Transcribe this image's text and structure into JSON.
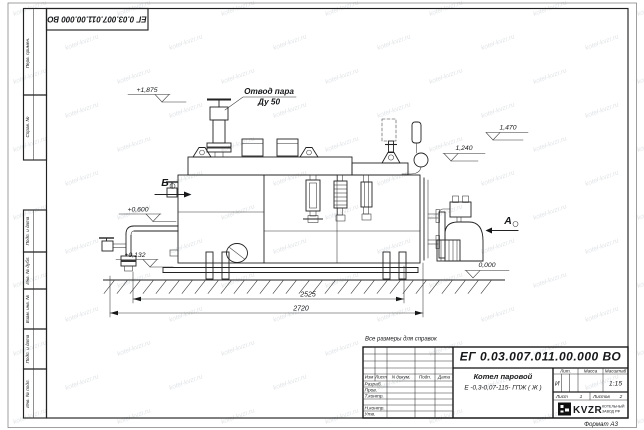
{
  "watermark": {
    "text": "kotel-kvzr.ru"
  },
  "frame": {
    "doc_number_top": "ЕГ 0.03.007.011.00.000  ВО",
    "format_label": "Формат А3",
    "margin_boxes": [
      "Перв. примен.",
      "Справ. №",
      "Подп. и дата",
      "Инв. № дубл.",
      "Взам. инв. №",
      "Подп. и дата",
      "Инв. № подл."
    ]
  },
  "drawing": {
    "note": "Все размеры для справок",
    "labels": {
      "steam_outlet_line1": "Отвод пара",
      "steam_outlet_line2": "Ду 50",
      "view_b": "Б",
      "view_a": "А"
    },
    "elevations": [
      "+1,875",
      "+0,600",
      "+0,132",
      "1,470",
      "1,240",
      "0,000"
    ],
    "dimensions": [
      "2525",
      "2720"
    ]
  },
  "title_block": {
    "doc_number": "ЕГ 0.03.007.011.00.000  ВО",
    "product_line1": "Котел паровой",
    "product_line2": "Е -0,3-0,07-115- ГПЖ ( Ж )",
    "header": [
      "Изм",
      "Лист",
      "N докум.",
      "Подп.",
      "Дата"
    ],
    "sign_rows": [
      "Разраб.",
      "Пров.",
      "Т.контр.",
      "Н.контр.",
      "Утв."
    ],
    "stat_header": [
      "Лит.",
      "Масса",
      "Масштаб"
    ],
    "lit_value": "И",
    "scale_value": "1:15",
    "sheet_label": "Лист",
    "sheet_value": "1",
    "sheets_label": "Листов",
    "sheets_value": "2",
    "company": {
      "logo_text": "KVZR",
      "name_line1": "КОТЕЛЬНЫЙ",
      "name_line2": "ЗАВОД РФ"
    }
  }
}
